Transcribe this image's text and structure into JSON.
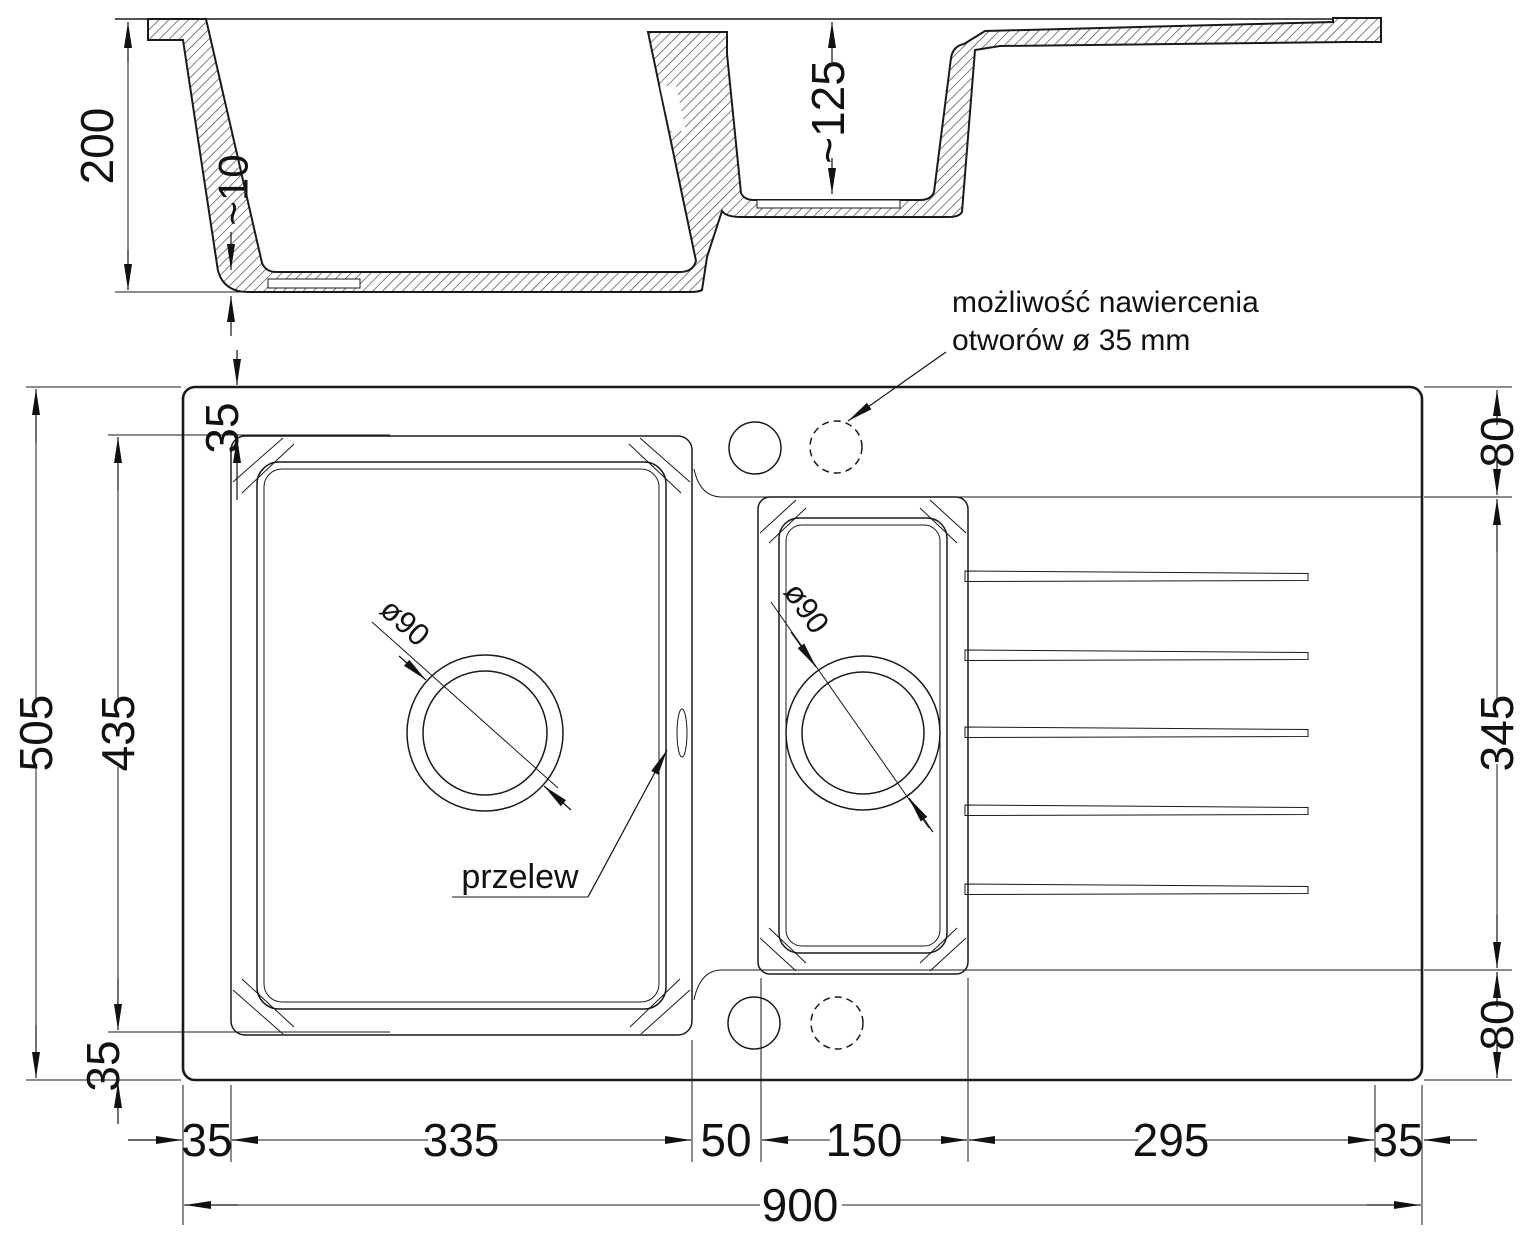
{
  "annotation": {
    "line1": "możliwość nawiercenia",
    "line2": "otworów ø 35 mm"
  },
  "labels": {
    "overflow": "przelew",
    "main_drain": "ø90",
    "small_drain": "ø90"
  },
  "dimensions": {
    "section": {
      "depth": "200",
      "bottom_thickness": "~10",
      "small_depth": "~125"
    },
    "left": {
      "total": "505",
      "bowl": "435",
      "top_border": "35",
      "bottom_border": "35"
    },
    "right": {
      "top": "80",
      "middle": "345",
      "bottom": "80"
    },
    "bottom": {
      "d1": "35",
      "d2": "335",
      "d3": "50",
      "d4": "150",
      "d5": "295",
      "d6": "35",
      "total": "900"
    }
  }
}
